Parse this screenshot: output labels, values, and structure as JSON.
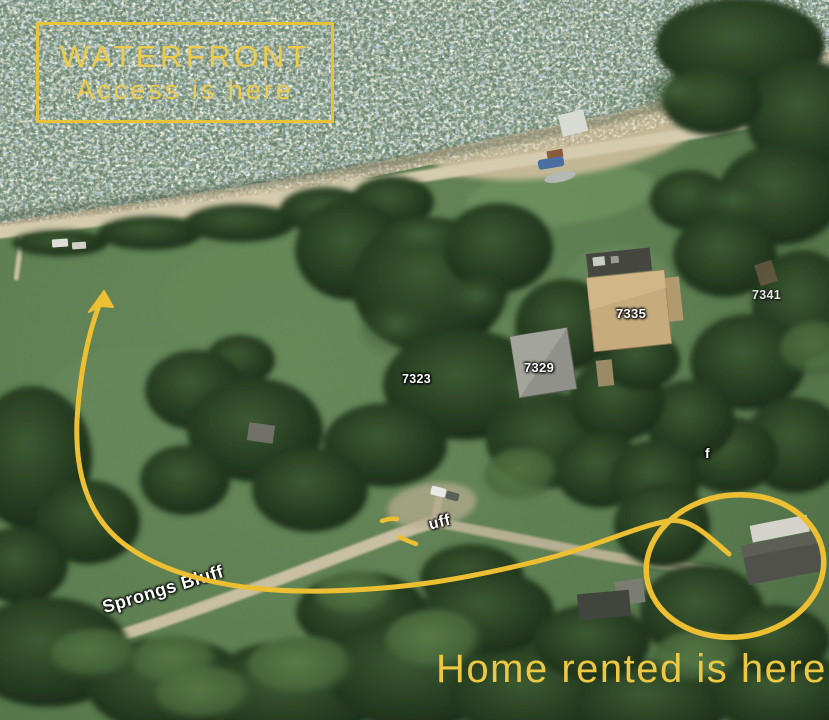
{
  "annotations": {
    "waterfront_box": {
      "line1": "WATERFRONT",
      "line2": "Access is here"
    },
    "home_label": "Home rented is here",
    "accent_color": "#edc63e"
  },
  "map_labels": {
    "road": "Sprongs Bluff",
    "road_partial": "uff",
    "road_partial_2": "f",
    "house_numbers": [
      "7335",
      "7341",
      "7323",
      "7329"
    ]
  },
  "palette": {
    "annotation_yellow": "#edc63e",
    "field_green": "#5e8152",
    "tree_dark": "#22371e",
    "water_base": "#7d9884",
    "road_tan": "#d5cbaf"
  }
}
